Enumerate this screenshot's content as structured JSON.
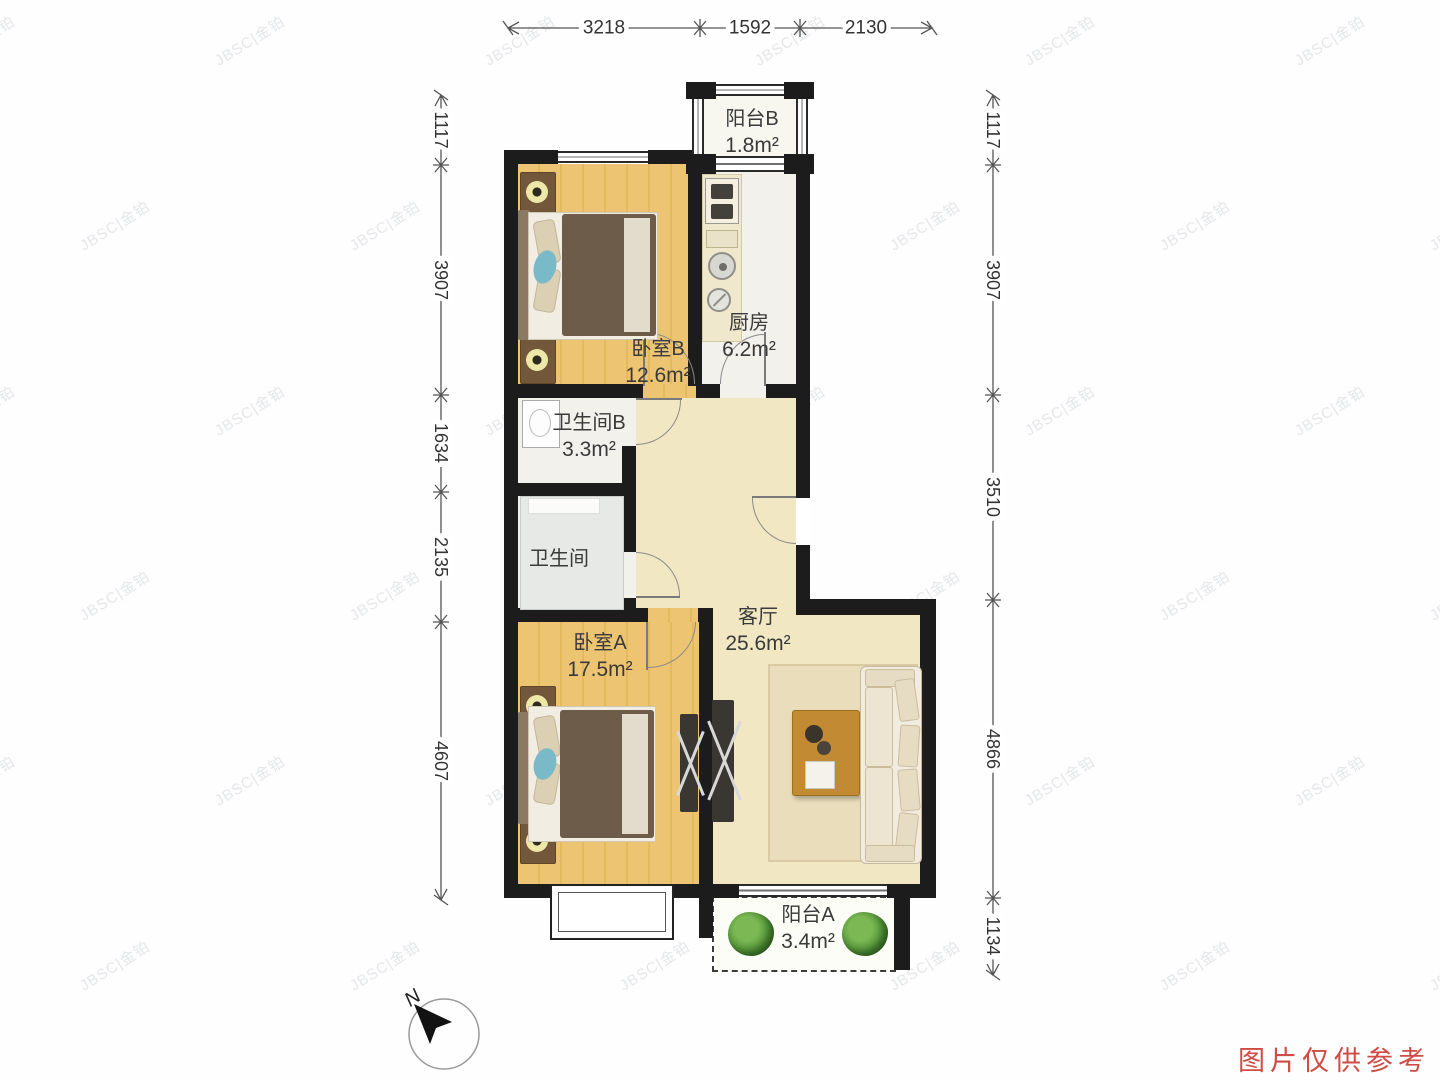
{
  "watermark": {
    "text": "JBSC|金铂"
  },
  "disclaimer": "图片仅供参考",
  "compass": {
    "label": "N"
  },
  "dimensions": {
    "top": [
      "3218",
      "1592",
      "2130"
    ],
    "left": [
      "1117",
      "3907",
      "1634",
      "2135",
      "4607"
    ],
    "right": [
      "1117",
      "3907",
      "3510",
      "4866",
      "1134"
    ]
  },
  "rooms": {
    "balcony_b": {
      "name": "阳台B",
      "area": "1.8m²"
    },
    "kitchen": {
      "name": "厨房",
      "area": "6.2m²"
    },
    "bedroom_b": {
      "name": "卧室B",
      "area": "12.6m²"
    },
    "bath_b": {
      "name": "卫生间B",
      "area": "3.3m²"
    },
    "bath": {
      "name": "卫生间",
      "area": ""
    },
    "bedroom_a": {
      "name": "卧室A",
      "area": "17.5m²"
    },
    "living": {
      "name": "客厅",
      "area": "25.6m²"
    },
    "balcony_a": {
      "name": "阳台A",
      "area": "3.4m²"
    }
  }
}
